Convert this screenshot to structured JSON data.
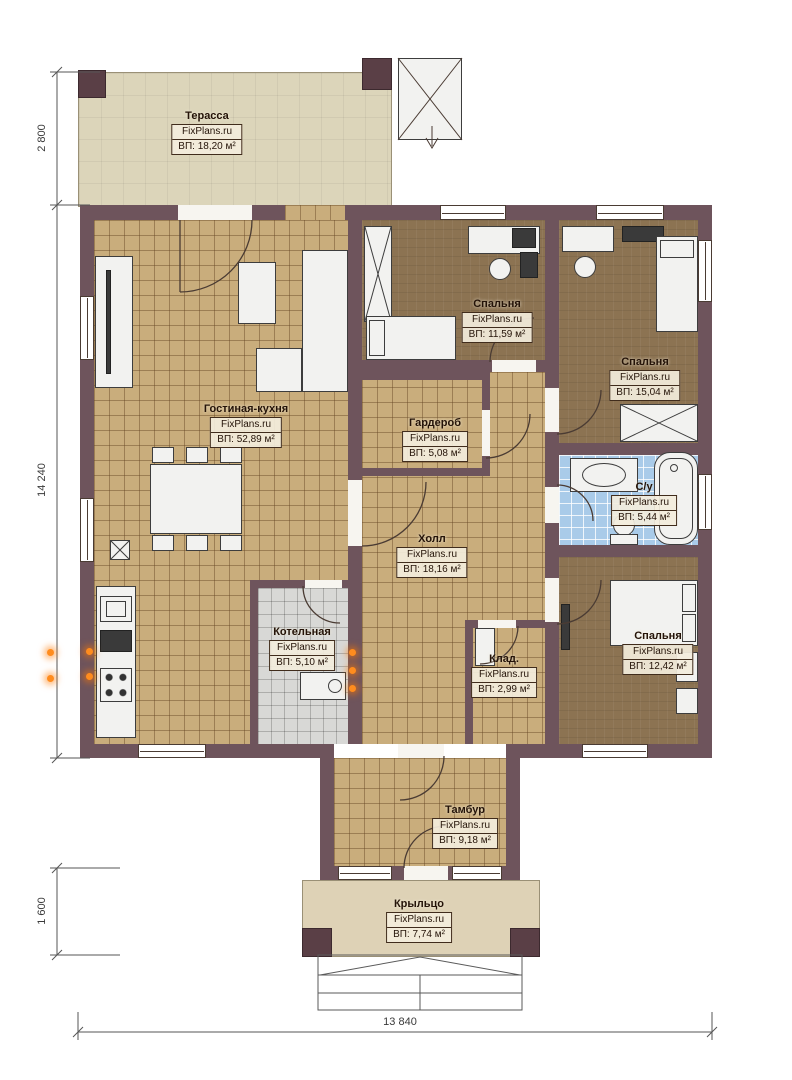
{
  "plan": {
    "brand": "FixPlans.ru",
    "rooms": [
      {
        "id": "terrace",
        "name": "Терасса",
        "area": "ВП: 18,20 м²"
      },
      {
        "id": "bedroom-top",
        "name": "Спальня",
        "area": "ВП: 11,59 м²"
      },
      {
        "id": "bedroom-right",
        "name": "Спальня",
        "area": "ВП: 15,04 м²"
      },
      {
        "id": "living-kitchen",
        "name": "Гостиная-кухня",
        "area": "ВП: 52,89 м²"
      },
      {
        "id": "wardrobe",
        "name": "Гардероб",
        "area": "ВП: 5,08 м²"
      },
      {
        "id": "hall",
        "name": "Холл",
        "area": "ВП: 18,16 м²"
      },
      {
        "id": "bathroom",
        "name": "С/у",
        "area": "ВП: 5,44 м²"
      },
      {
        "id": "boiler",
        "name": "Котельная",
        "area": "ВП: 5,10 м²"
      },
      {
        "id": "storage",
        "name": "Клад.",
        "area": "ВП: 2,99 м²"
      },
      {
        "id": "bedroom-bottom",
        "name": "Спальня",
        "area": "ВП: 12,42 м²"
      },
      {
        "id": "vestibule",
        "name": "Тамбур",
        "area": "ВП: 9,18 м²"
      },
      {
        "id": "porch",
        "name": "Крыльцо",
        "area": "ВП: 7,74 м²"
      }
    ],
    "dimensions": {
      "left_top": "2 800",
      "left_side": "14 240",
      "left_bottom": "1 600",
      "bottom": "13 840"
    },
    "colors": {
      "wall": "#6e545c",
      "tile_floor": "#c9ad7c",
      "wood_floor": "#8c7352",
      "bath_tile": "#a9cbe9",
      "boiler_tile": "#d8d8d6",
      "terrace_floor": "#dcd5ba",
      "porch_floor": "#ded2b6",
      "radiator_accent": "#ff8c1e"
    }
  }
}
